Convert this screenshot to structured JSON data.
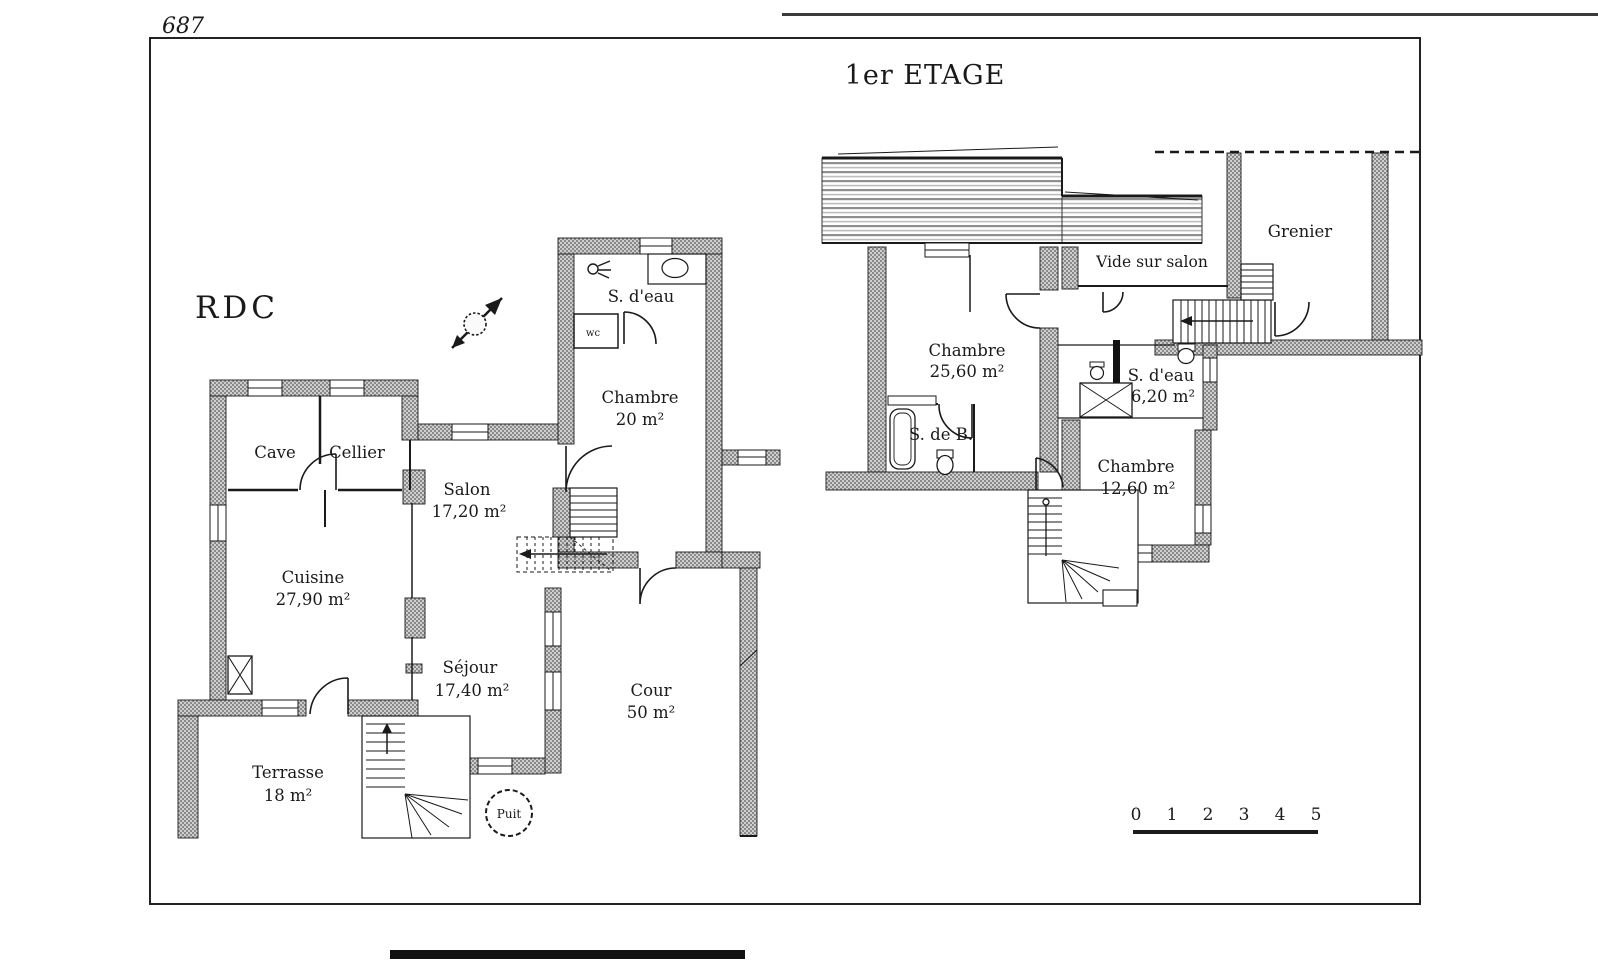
{
  "page": {
    "number": "687"
  },
  "titles": {
    "etage": "1er ETAGE",
    "rdc": "RDC"
  },
  "rdc": {
    "rooms": {
      "cave": {
        "name": "Cave"
      },
      "cellier": {
        "name": "Cellier"
      },
      "salon": {
        "name": "Salon",
        "area": "17,20 m²"
      },
      "cuisine": {
        "name": "Cuisine",
        "area": "27,90 m²"
      },
      "sejour": {
        "name": "Séjour",
        "area": "17,40 m²"
      },
      "chambre": {
        "name": "Chambre",
        "area": "20 m²"
      },
      "sdeau": {
        "name": "S. d'eau"
      },
      "wc": {
        "name": "wc"
      },
      "terrasse": {
        "name": "Terrasse",
        "area": "18 m²"
      },
      "cour": {
        "name": "Cour",
        "area": "50 m²"
      },
      "puit": {
        "name": "Puit"
      }
    }
  },
  "etage": {
    "rooms": {
      "chambre1": {
        "name": "Chambre",
        "area": "25,60 m²"
      },
      "sdb": {
        "name": "S. de B."
      },
      "sdeau": {
        "name": "S. d'eau",
        "area": "6,20 m²"
      },
      "chambre2": {
        "name": "Chambre",
        "area": "12,60 m²"
      },
      "vide": {
        "name": "Vide sur salon"
      },
      "grenier": {
        "name": "Grenier"
      }
    }
  },
  "scale_bar": {
    "labels": [
      "0",
      "1",
      "2",
      "3",
      "4",
      "5"
    ]
  },
  "colors": {
    "wall_dark": "#8a8a8a",
    "wall_light": "#cfcfcf",
    "line": "#1a1a1a",
    "paper": "#ffffff"
  }
}
